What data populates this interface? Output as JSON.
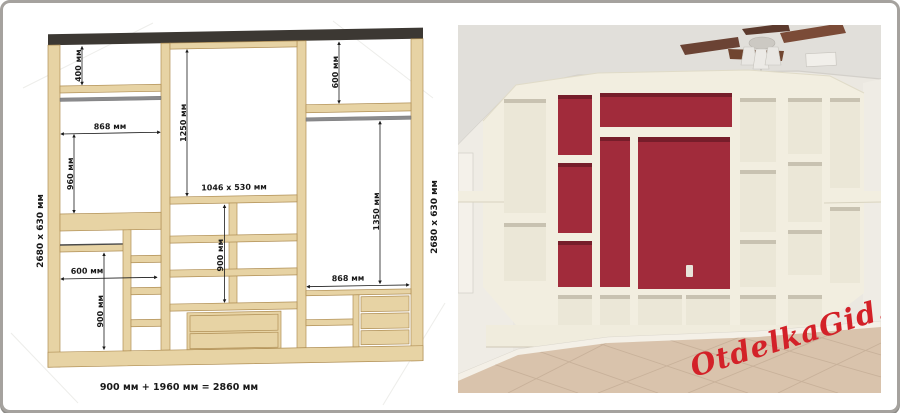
{
  "page": {
    "frame_border_color": "#a5a29e",
    "background_color": "#ffffff"
  },
  "diagram": {
    "left_side_label": "2680 x 630 мм",
    "right_side_label": "2680 x 630 мм",
    "center_area_label": "1046 x 530 мм",
    "total_width_label": "900 мм + 1960 мм = 2860 мм",
    "dimensions": {
      "d400": "400 мм",
      "d868_left": "868 мм",
      "d960": "960 мм",
      "d1250": "1250 мм",
      "d600_left": "600 мм",
      "d900_left": "900 мм",
      "d900_middle": "900 мм",
      "d600_right_top": "600 мм",
      "d1350": "1350 мм",
      "d868_right": "868 мм"
    },
    "colors": {
      "wood": "#e7d3a4",
      "wood_edge": "#b08f55",
      "top_band": "#3c3833",
      "rod_gray": "#8b8b8d",
      "dimension_line": "#1a1a1a"
    }
  },
  "photo": {
    "watermark": "OtdelkaGid.ru",
    "colors": {
      "red_niche": "#a12b3b",
      "unit_cream": "#f2eee0",
      "wall": "#ebe8e1",
      "ceiling": "#e1dfda",
      "floor_tile": "#d9c3ac",
      "fan_blade": "#6b4334",
      "watermark_red": "#d32128"
    }
  }
}
